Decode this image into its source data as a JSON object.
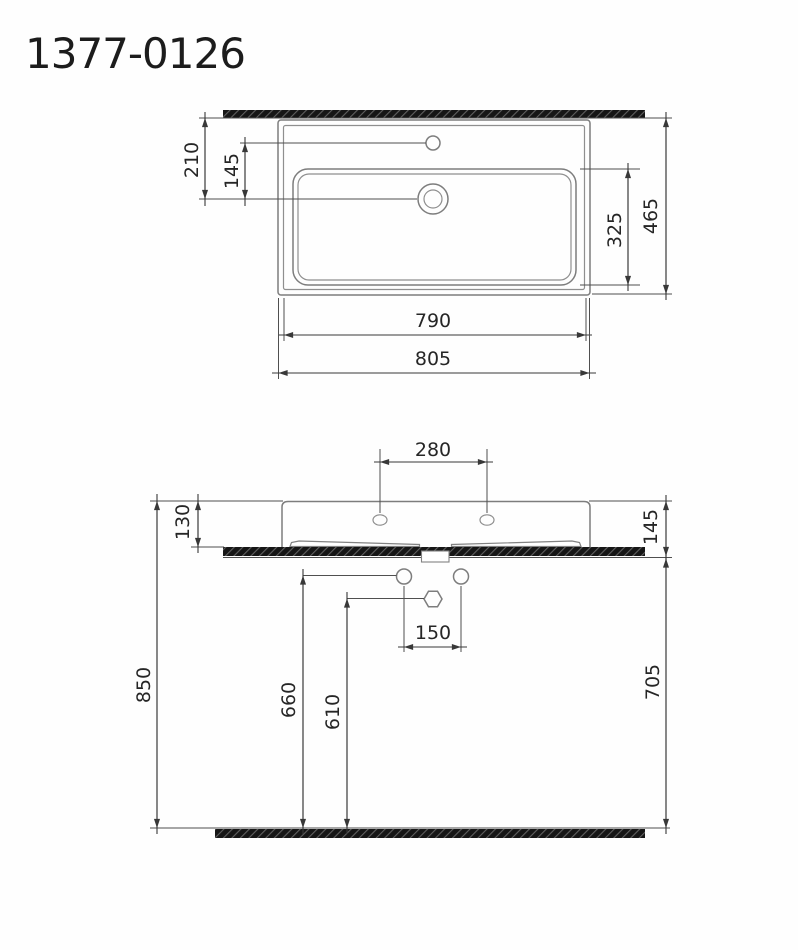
{
  "title": "1377-0126",
  "drawing": {
    "kind": "washbasin dimension drawing",
    "views": [
      "plan view",
      "front elevation"
    ]
  },
  "colors": {
    "object_line": "#7d7d7d",
    "dimension_line": "#383838",
    "text": "#262626",
    "hatch_fill": "#161616",
    "background": "#fefefe"
  },
  "plan_view": {
    "dims": {
      "wall_to_drain": "210",
      "tap_to_drain": "145",
      "overall_depth": "465",
      "basin_depth": "325",
      "basin_width": "790",
      "overall_width": "805"
    }
  },
  "front_view": {
    "dims": {
      "tap_hole_spacing": "280",
      "rim_above_counter": "130",
      "rim_to_counter_underside": "145",
      "rim_height": "850",
      "supply_height": "660",
      "trap_height": "610",
      "counter_underside_height": "705",
      "supply_hole_spacing": "150"
    }
  }
}
